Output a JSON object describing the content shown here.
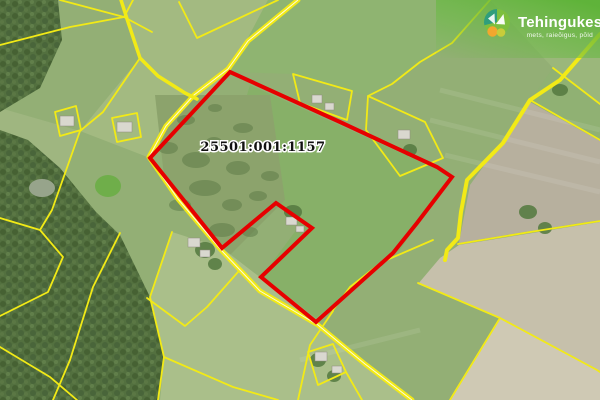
{
  "map": {
    "parcel_label": "25501:001:1157"
  },
  "watermark": {
    "brand": "Tehingukeskus",
    "tagline": "mets, raieõigus, põld"
  },
  "colors": {
    "boundary_red": "#e60000",
    "cadastral_yellow": "#f2ea16",
    "road_centerline_white": "#ffffff",
    "watermark_green": "#68ba42",
    "brand_text_white": "#ffffff",
    "label_text_black": "#111111",
    "logo_teal": "#2f9e7c",
    "logo_green": "#7dbf3e",
    "logo_orange": "#f2a72e",
    "logo_yellow": "#c8cc3a"
  }
}
